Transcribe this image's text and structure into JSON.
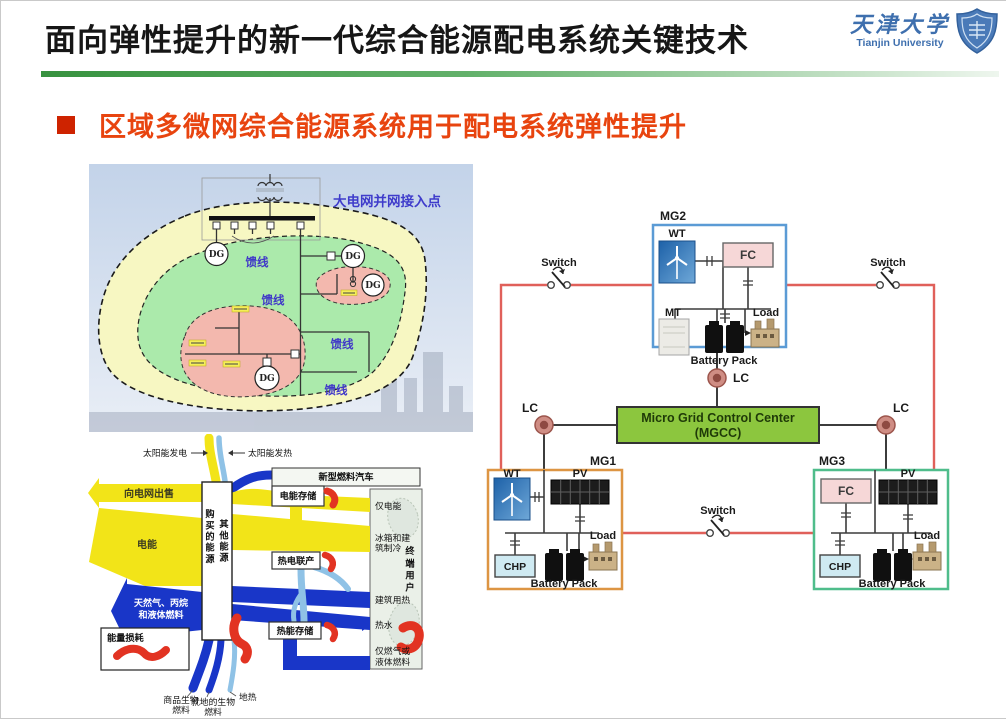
{
  "header": {
    "title": "面向弹性提升的新一代综合能源配电系统关键技术",
    "logo_cn": "天津大学",
    "logo_en": "Tianjin University"
  },
  "subtitle": {
    "text": "区域多微网综合能源系统用于配电系统弹性提升"
  },
  "map": {
    "grid_point": "大电网并网接入点",
    "feeder": "馈线",
    "dg": "DG"
  },
  "sankey": {
    "solar_power": "太阳能发电",
    "solar_heat": "太阳能发热",
    "sell_to_grid": "向电网出售",
    "electricity": "电能",
    "gas_fuel_l1": "天然气、丙烷",
    "gas_fuel_l2": "和液体燃料",
    "purchased_energy": "购买的能源",
    "other_energy": "其他能源",
    "electric_storage": "电能存储",
    "new_fuel_vehicle": "新型燃料汽车",
    "chp": "热电联产",
    "thermal_storage": "热能存储",
    "end_user": "终端用户",
    "electricity_only": "仅电能",
    "cooling_l1": "冰箱和建",
    "cooling_l2": "筑制冷",
    "building_heat": "建筑用热",
    "hot_water": "热水",
    "fuel_only_l1": "仅燃气或",
    "fuel_only_l2": "液体燃料",
    "energy_loss": "能量损耗",
    "commercial_bio_l1": "商品生物",
    "commercial_bio_l2": "燃料",
    "local_bio_l1": "就地的生物",
    "local_bio_l2": "燃料",
    "geothermal": "地热"
  },
  "network": {
    "mg1": "MG1",
    "mg2": "MG2",
    "mg3": "MG3",
    "mgcc_l1": "Micro Grid Control Center",
    "mgcc_l2": "(MGCC)",
    "lc": "LC",
    "switch": "Switch",
    "wt": "WT",
    "pv": "PV",
    "fc": "FC",
    "mt": "MT",
    "chp": "CHP",
    "load": "Load",
    "battery_pack": "Battery Pack"
  },
  "colors": {
    "subtitle_red": "#e8440f",
    "divider_green": "#37923f",
    "ring_red": "#e0605a",
    "mg1_border": "#dd9543",
    "mg2_border": "#5b9bd5",
    "mg3_border": "#4fbd8b",
    "mgcc_fill": "#8cc63e",
    "sankey_yellow": "#f2e418",
    "sankey_blue": "#1936c8",
    "sankey_lightblue": "#8fc2e6",
    "loss_red": "#e23322",
    "map_yellow": "#f7f7c2",
    "map_green": "#abeaab",
    "map_pink": "#f3b8ae"
  }
}
